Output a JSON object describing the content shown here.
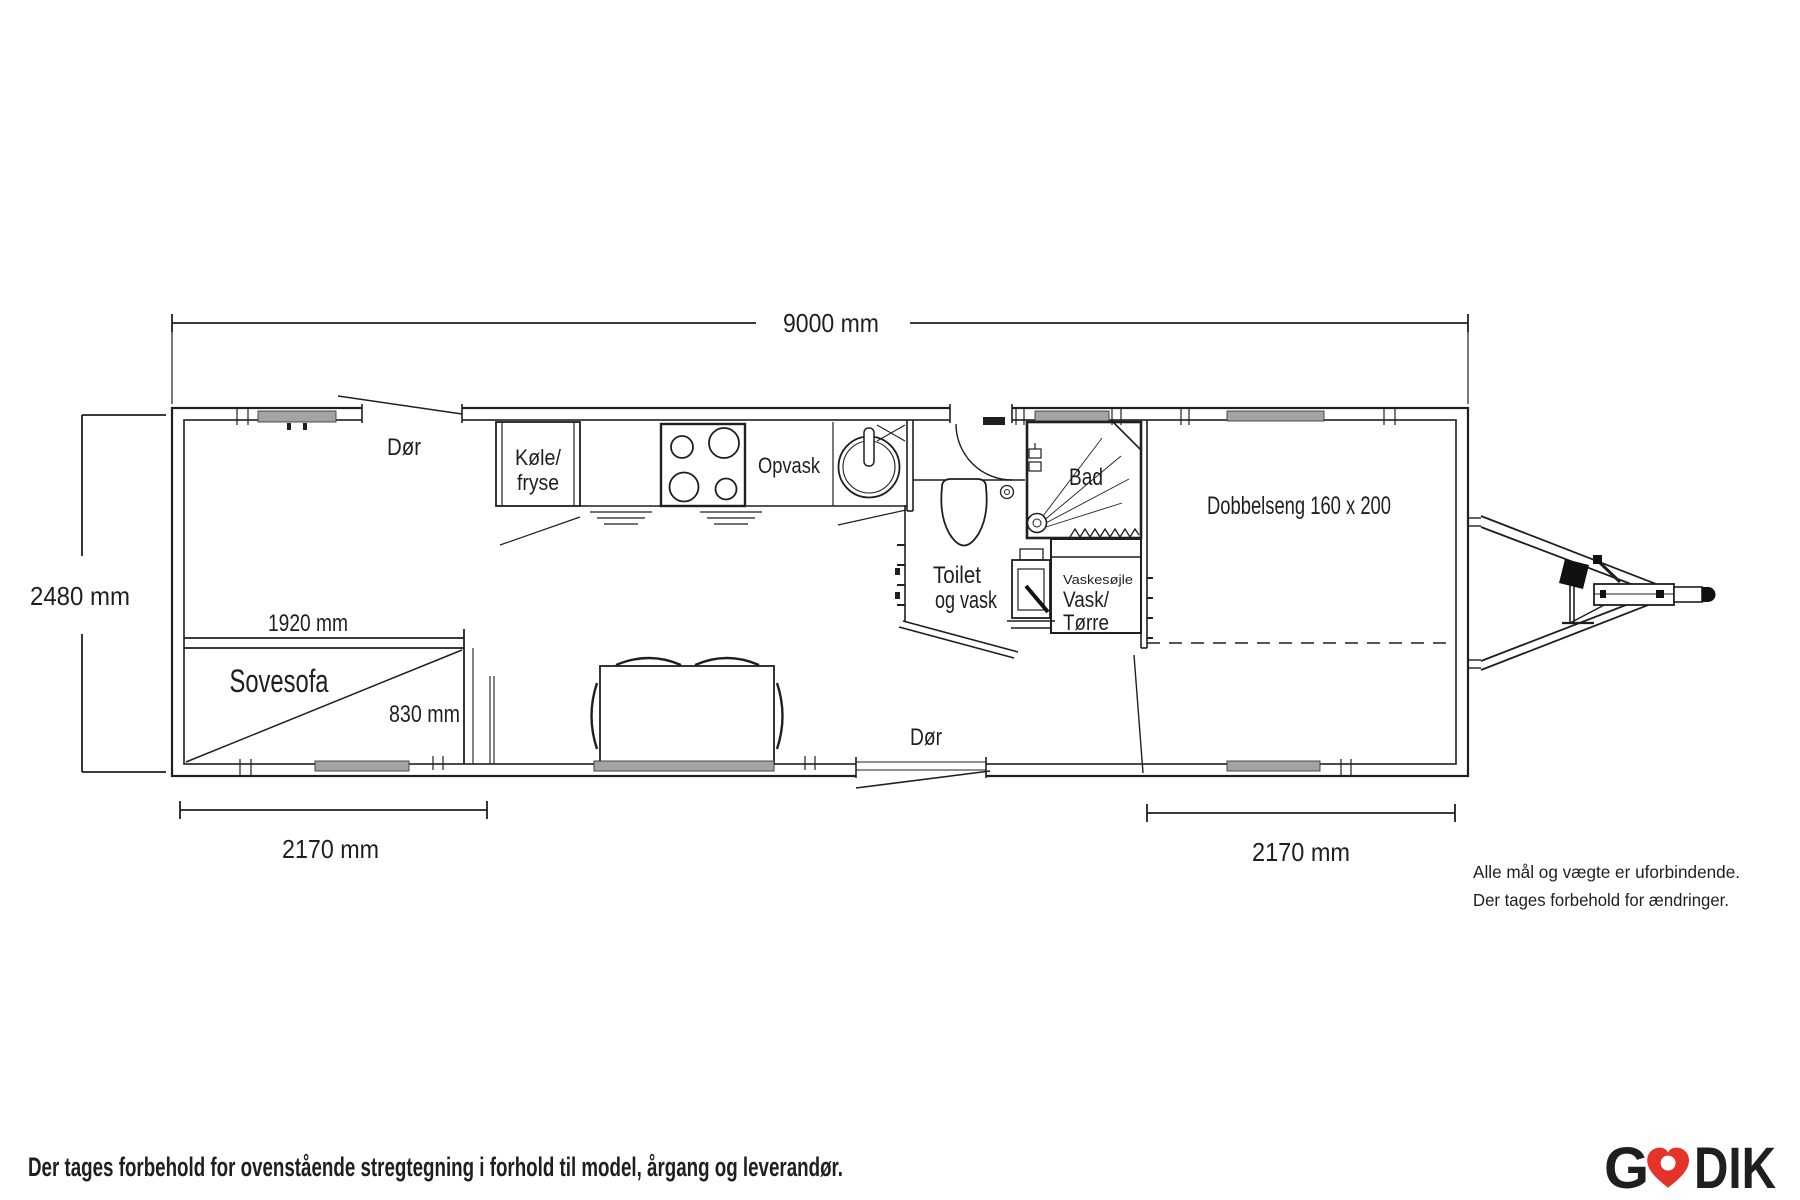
{
  "dims": {
    "length": "9000 mm",
    "height": "2480 mm",
    "left": "2170 mm",
    "right": "2170 mm",
    "sofa_len": "1920 mm",
    "sofa_dep": "830 mm"
  },
  "rooms": {
    "door_top": "Dør",
    "door_bottom": "Dør",
    "fridge1": "Køle/",
    "fridge2": "fryse",
    "dishes": "Opvask",
    "bath": "Bad",
    "toilet1": "Toilet",
    "toilet2": "og vask",
    "washcol": "Vaskesøjle",
    "wash1": "Vask/",
    "wash2": "Tørre",
    "bed": "Dobbelseng 160 x 200",
    "sofa": "Sovesofa"
  },
  "note": {
    "line1": "Alle mål og vægte er uforbindende.",
    "line2": "Der tages forbehold for ændringer."
  },
  "footer": {
    "disclaimer": "Der tages forbehold for ovenstående stregtegning i forhold til model, årgang og leverandør."
  },
  "logo": {
    "part1": "G",
    "part2": "DIK",
    "green": "#169a4b",
    "red": "#e63329"
  }
}
